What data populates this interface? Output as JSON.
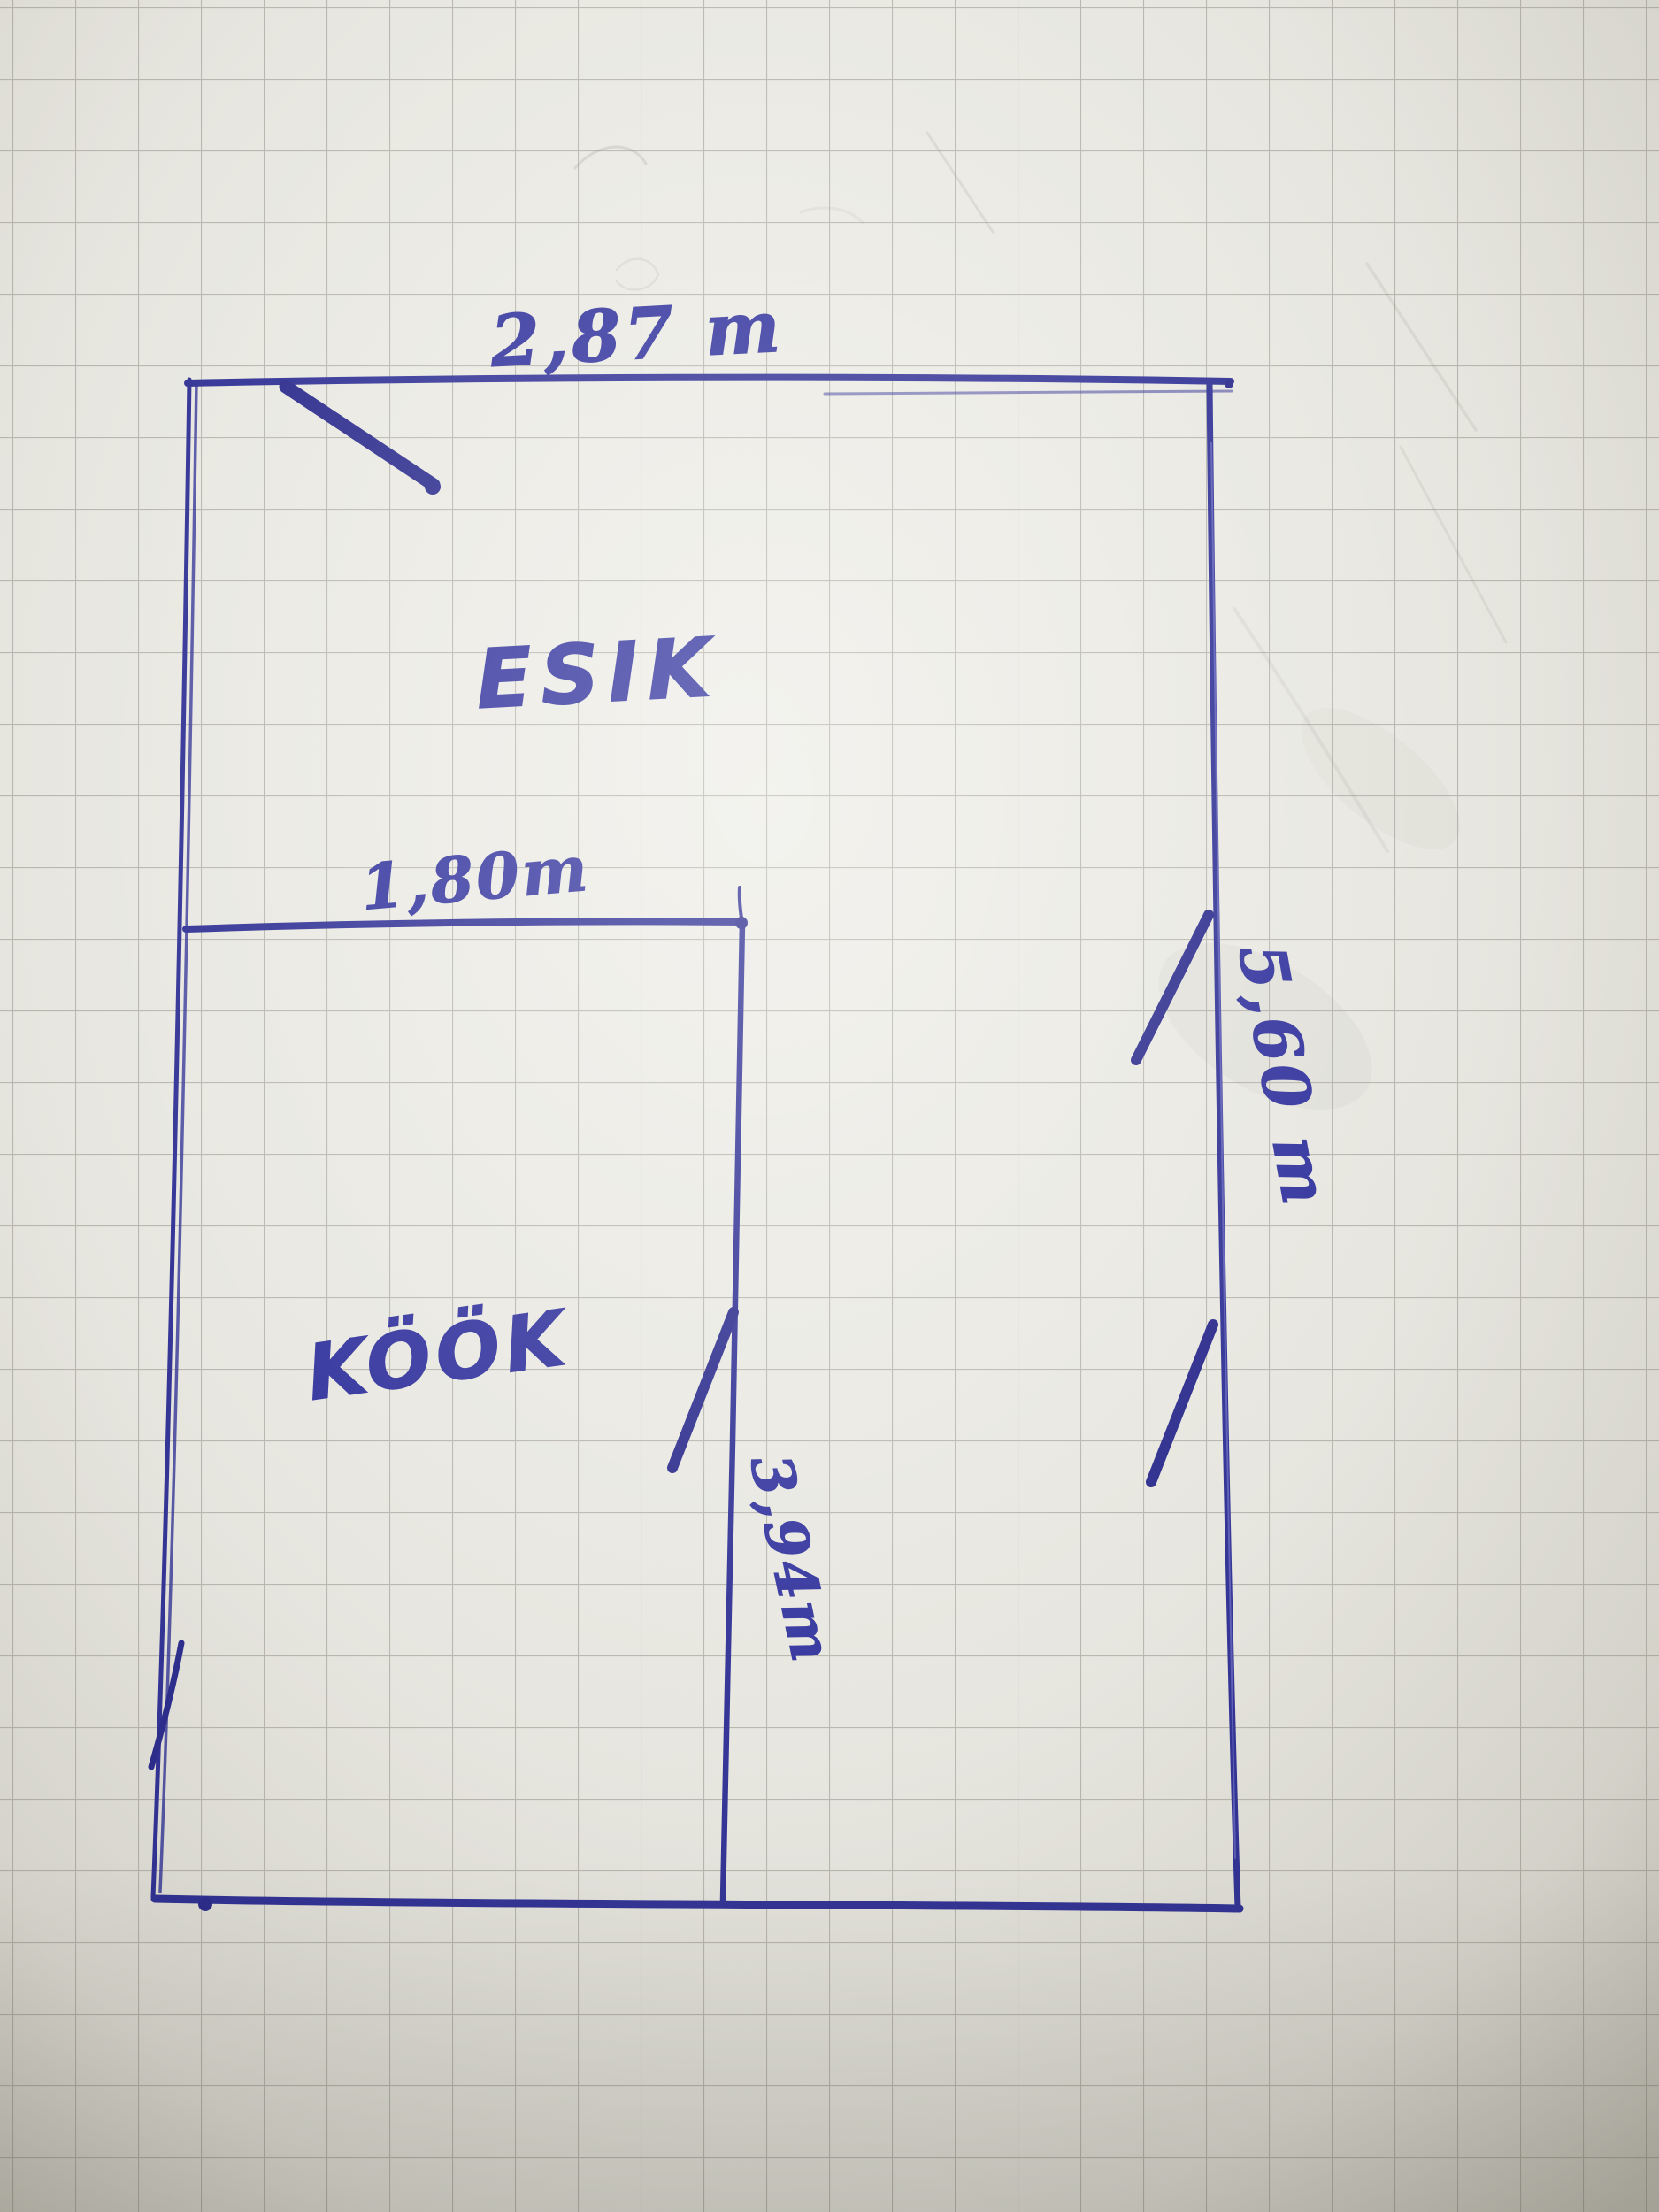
{
  "page": {
    "paper_color": "#e7e6df",
    "grid_color": "#96948a",
    "ink_color": "#2b2c92"
  },
  "floor_plan": {
    "rooms": [
      {
        "name": "ESIK"
      },
      {
        "name": "KÖÖK"
      }
    ],
    "dimensions": {
      "top_width": "2,87 m",
      "partition_width": "1,80m",
      "right_height": "5,60 m",
      "partition_height": "3,94m"
    }
  }
}
